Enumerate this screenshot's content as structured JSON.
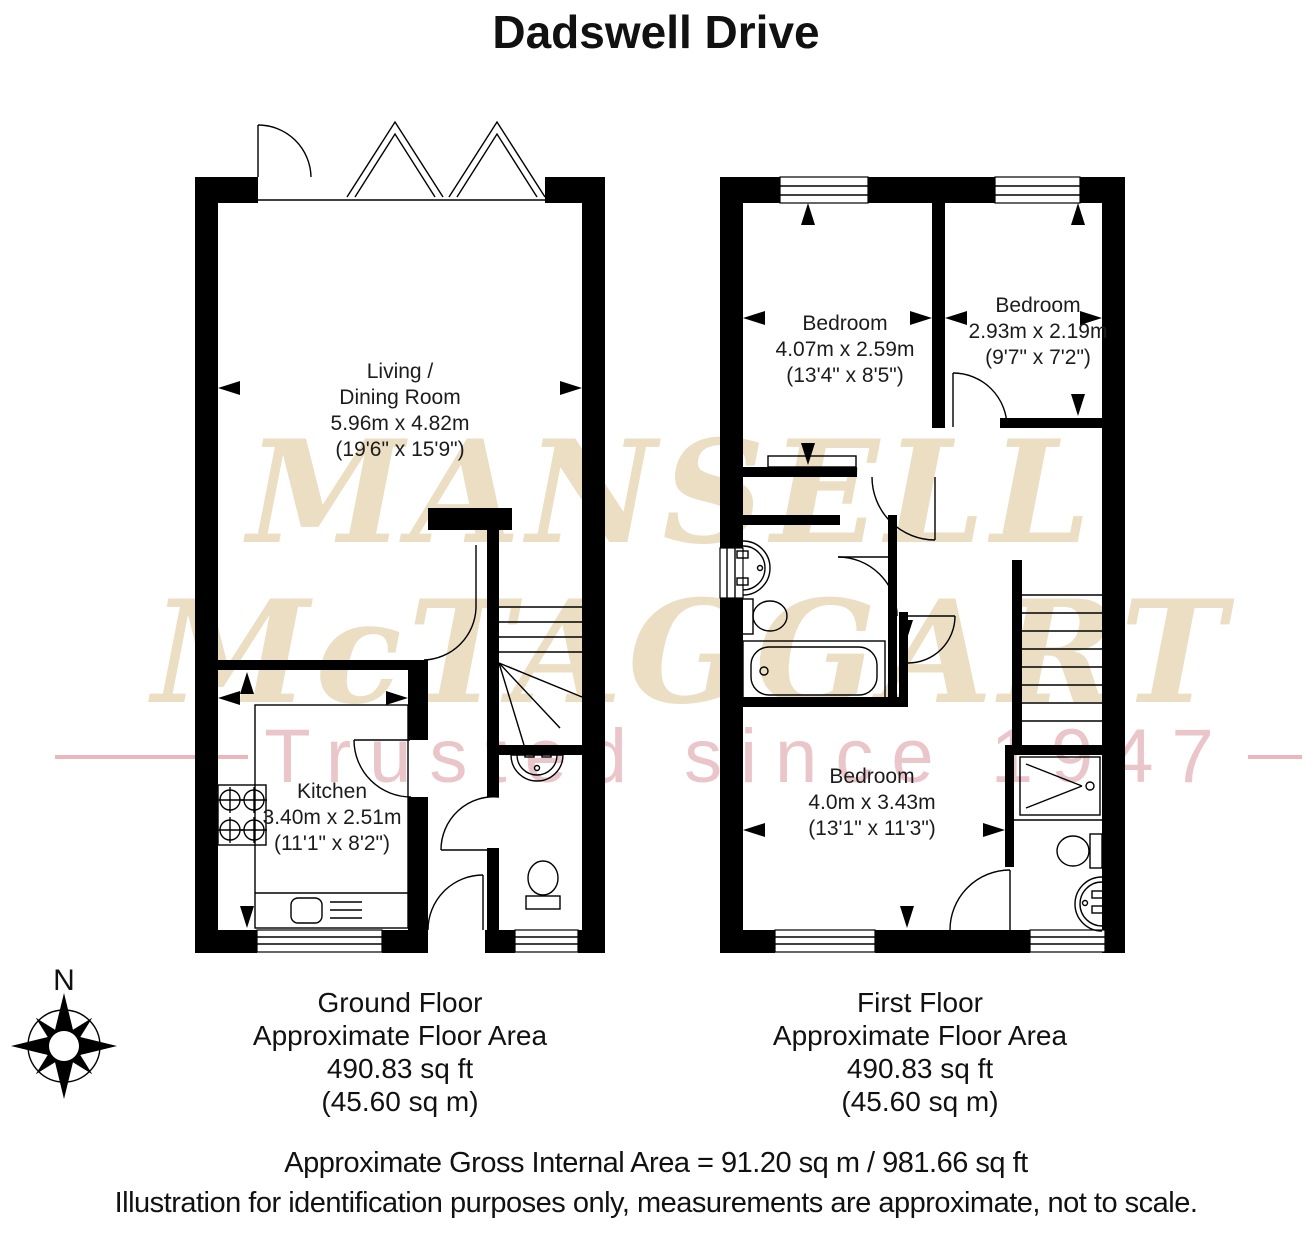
{
  "title": "Dadswell Drive",
  "watermark": {
    "line1": "MANSELL",
    "line2": "McTAGGART",
    "tagline": "Trusted since 1947"
  },
  "compass": {
    "north_label": "N"
  },
  "ground_floor": {
    "rooms": {
      "living_dining": {
        "name_line1": "Living /",
        "name_line2": "Dining Room",
        "metric": "5.96m x 4.82m",
        "imperial": "(19'6\" x 15'9\")"
      },
      "kitchen": {
        "name": "Kitchen",
        "metric": "3.40m x 2.51m",
        "imperial": "(11'1\" x 8'2\")"
      }
    },
    "caption": {
      "line1": "Ground Floor",
      "line2": "Approximate Floor Area",
      "line3": "490.83 sq ft",
      "line4": "(45.60 sq m)"
    }
  },
  "first_floor": {
    "rooms": {
      "bedroom_left": {
        "name": "Bedroom",
        "metric": "4.07m x 2.59m",
        "imperial": "(13'4\" x 8'5\")"
      },
      "bedroom_right": {
        "name": "Bedroom",
        "metric": "2.93m x 2.19m",
        "imperial": "(9'7\" x 7'2\")"
      },
      "bedroom_bottom": {
        "name": "Bedroom",
        "metric": "4.0m x 3.43m",
        "imperial": "(13'1\" x 11'3\")"
      }
    },
    "caption": {
      "line1": "First Floor",
      "line2": "Approximate Floor Area",
      "line3": "490.83 sq ft",
      "line4": "(45.60 sq m)"
    }
  },
  "footer": {
    "line1": "Approximate Gross Internal Area = 91.20 sq m / 981.66 sq ft",
    "line2": "Illustration for identification purposes only, measurements are approximate, not to scale."
  },
  "colors": {
    "wall": "#000000",
    "watermark_beige": "#ebdec3",
    "watermark_pink_text": "#eac6ca",
    "watermark_pink_line": "#e9b7bc"
  }
}
